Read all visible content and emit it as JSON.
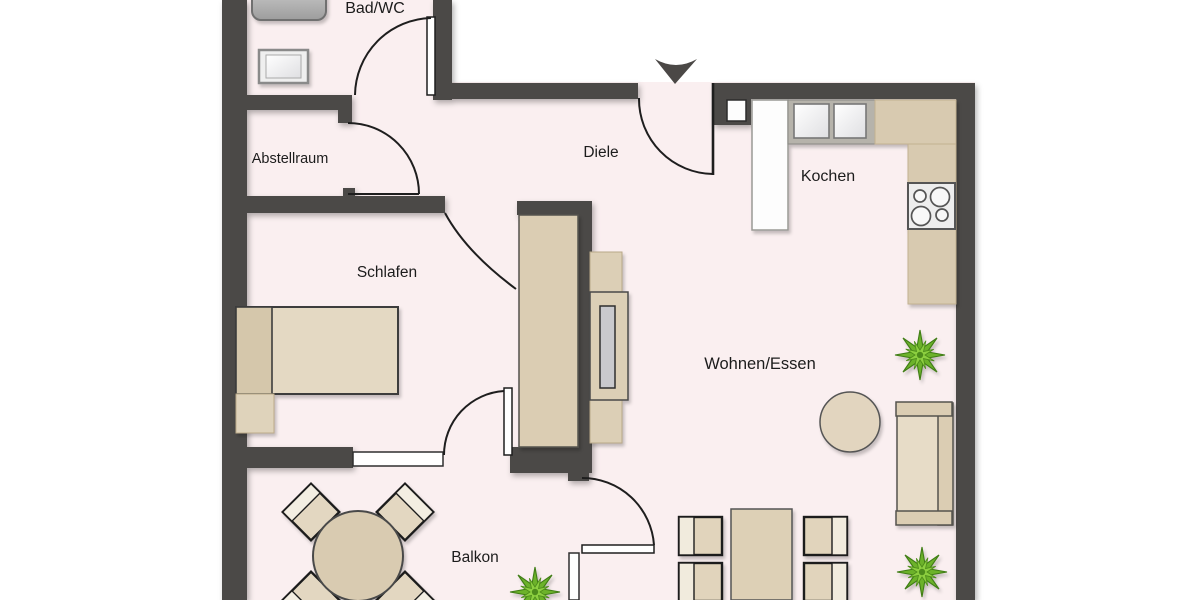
{
  "type": "floor-plan",
  "language": "de",
  "rooms": {
    "bad_wc": {
      "label": "Bad/WC",
      "furniture": [
        "bathtub (cropped at top edge)",
        "washbasin"
      ]
    },
    "abstellraum": {
      "label": "Abstellraum",
      "furniture": []
    },
    "diele": {
      "label": "Diele",
      "furniture": [
        "entrance-door",
        "entrance-arrow",
        "wall-niche"
      ]
    },
    "kochen": {
      "label": "Kochen",
      "furniture": [
        "tall-cabinet",
        "double-sink",
        "l-shaped-countertop",
        "cooktop-4-burners"
      ]
    },
    "schlafen": {
      "label": "Schlafen",
      "furniture": [
        "single-bed",
        "nightstand",
        "wardrobe",
        "window-to-balcony",
        "door-to-balcony"
      ]
    },
    "wohnen_essen": {
      "label": "Wohnen/Essen",
      "furniture": [
        "tv-sideboard",
        "tv",
        "round-side-table",
        "sofa",
        "dining-table",
        "dining-chairs-x4",
        "potted-plant-x2",
        "balcony-door"
      ]
    },
    "balkon": {
      "label": "Balkon",
      "furniture": [
        "round-table",
        "chairs-x4",
        "potted-plant"
      ]
    }
  },
  "icons": {
    "entrance_arrow": "filled triangle pointing down at apartment entry"
  },
  "colors": {
    "background": "#ffffff",
    "floor": "#faeff0",
    "wall": "#4b4846",
    "furniture_tan": "#ddd0b6",
    "furniture_tan_light": "#e6dbc6",
    "furniture_tan_dark": "#d5c7ab",
    "counter_tan": "#d8cab0",
    "fixture_white": "#fafafa",
    "plant_green": "#6cb22b",
    "plant_green_light": "#8ccf3f",
    "tv_screen": "#c9c9cd"
  }
}
